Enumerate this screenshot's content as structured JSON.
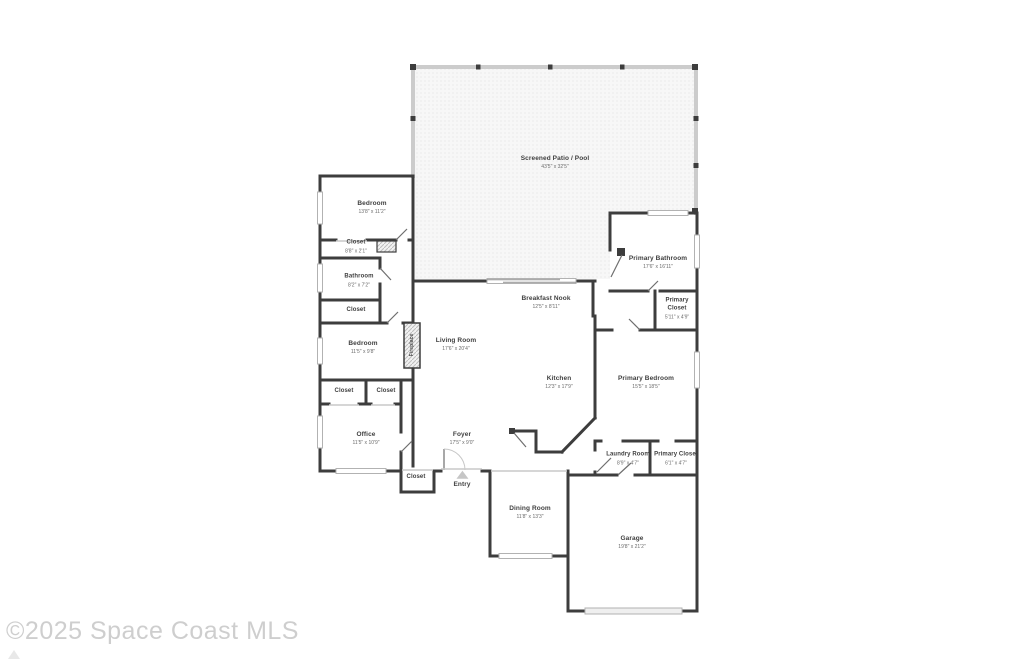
{
  "watermark": {
    "text": "©2025 Space Coast MLS"
  },
  "colors": {
    "wall": "#3d3d3d",
    "screen_wall": "#cccccc",
    "room_name": "#3f3f3f",
    "room_dims": "#6b6b6b",
    "watermark": "#c9c9c9",
    "patio_fill": "#f7f7f7"
  },
  "rooms": {
    "patio": {
      "name": "Screened Patio / Pool",
      "dims": "43'5\" x 32'5\""
    },
    "bedroom1": {
      "name": "Bedroom",
      "dims": "13'8\" x 11'2\""
    },
    "closet1": {
      "name": "Closet",
      "dims": "8'8\" x 2'1\""
    },
    "bathroom": {
      "name": "Bathroom",
      "dims": "8'2\" x 7'2\""
    },
    "closet2": {
      "name": "Closet"
    },
    "bedroom2": {
      "name": "Bedroom",
      "dims": "11'5\" x 9'8\""
    },
    "fireplace": {
      "name": "Fireplace"
    },
    "living": {
      "name": "Living Room",
      "dims": "17'6\" x 20'4\""
    },
    "nook": {
      "name": "Breakfast Nook",
      "dims": "12'5\" x 8'11\""
    },
    "kitchen": {
      "name": "Kitchen",
      "dims": "12'3\" x 17'9\""
    },
    "pbath": {
      "name": "Primary Bathroom",
      "dims": "17'6\" x 16'11\""
    },
    "pcloset1": {
      "name": "Primary Closet",
      "dims": "5'11\" x 4'9\""
    },
    "pbed": {
      "name": "Primary Bedroom",
      "dims": "15'5\" x 18'5\""
    },
    "closet3": {
      "name": "Closet"
    },
    "closet4": {
      "name": "Closet"
    },
    "office": {
      "name": "Office",
      "dims": "11'5\" x 10'9\""
    },
    "foyer": {
      "name": "Foyer",
      "dims": "17'5\" x 9'0\""
    },
    "laundry": {
      "name": "Laundry Room",
      "dims": "8'9\" x 4'7\""
    },
    "pcloset2": {
      "name": "Primary Closet",
      "dims": "6'1\" x 4'7\""
    },
    "closet5": {
      "name": "Closet"
    },
    "entry": {
      "name": "Entry"
    },
    "dining": {
      "name": "Dining Room",
      "dims": "11'8\" x 13'3\""
    },
    "garage": {
      "name": "Garage",
      "dims": "19'8\" x 21'2\""
    }
  }
}
